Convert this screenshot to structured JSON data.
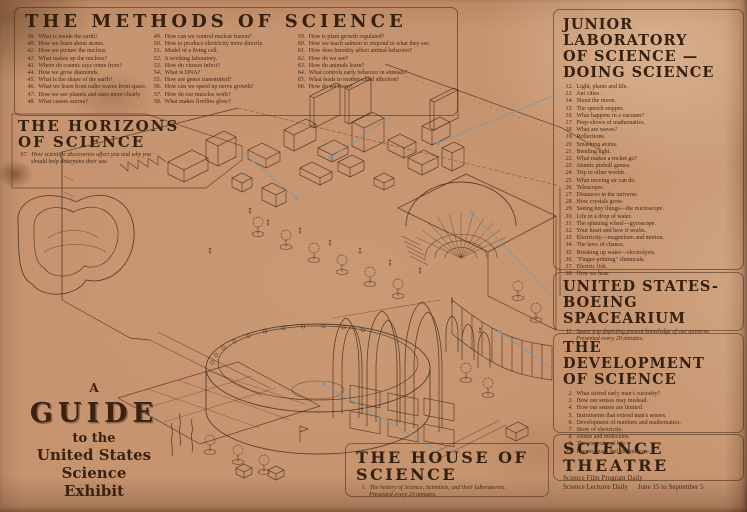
{
  "colors": {
    "paper": "#c6946f",
    "ink": "#4a3322",
    "leader": "#7b9aa4",
    "heading": "#33200f"
  },
  "guide_title": {
    "line1": "A",
    "line2": "GUIDE",
    "line3": "to the",
    "line4": "United States Science",
    "line5": "Exhibit"
  },
  "sections": {
    "methods": {
      "title": "THE METHODS OF SCIENCE",
      "columns": [
        [
          {
            "n": "39",
            "t": "What is inside the earth?"
          },
          {
            "n": "40",
            "t": "How we learn about atoms."
          },
          {
            "n": "41",
            "t": "How we picture the nucleus."
          },
          {
            "n": "42",
            "t": "What makes up the nucleus?"
          },
          {
            "n": "43",
            "t": "Where do cosmic rays come from?"
          },
          {
            "n": "44",
            "t": "How we grow diamonds."
          },
          {
            "n": "45",
            "t": "What is the shape of the earth?"
          },
          {
            "n": "46",
            "t": "What we learn from radio waves from space."
          },
          {
            "n": "47",
            "t": "How we see planets and stars more clearly"
          },
          {
            "n": "48",
            "t": "What causes aurora?"
          }
        ],
        [
          {
            "n": "49",
            "t": "How can we control nuclear fusion?"
          },
          {
            "n": "50",
            "t": "How to produce electricity more directly."
          },
          {
            "n": "51",
            "t": "Model of a living cell."
          },
          {
            "n": "52",
            "t": "A working laboratory."
          },
          {
            "n": "53",
            "t": "How do viruses infect?"
          },
          {
            "n": "54",
            "t": "What is DNA?"
          },
          {
            "n": "55",
            "t": "How are genes transmitted?"
          },
          {
            "n": "56",
            "t": "How can we speed up nerve growth?"
          },
          {
            "n": "57",
            "t": "How do our muscles work?"
          },
          {
            "n": "58",
            "t": "What makes fireflies glow?"
          }
        ],
        [
          {
            "n": "59",
            "t": "How is plant growth regulated?"
          },
          {
            "n": "60",
            "t": "How we teach salmon to respond to what they see."
          },
          {
            "n": "61",
            "t": "How does heredity affect animal behavior?"
          },
          {
            "n": "62",
            "t": "How do we see?"
          },
          {
            "n": "63",
            "t": "How do animals learn?"
          },
          {
            "n": "64",
            "t": "What controls early behavior in animals?"
          },
          {
            "n": "65",
            "t": "What leads to mother-child affection?"
          },
          {
            "n": "66",
            "t": "How do we learn?"
          }
        ]
      ]
    },
    "horizons": {
      "title_lines": [
        "THE HORIZONS",
        "OF SCIENCE"
      ],
      "items": [
        {
          "n": "67",
          "t": "How scientific discoveries affect you and why you should help determine their use."
        }
      ]
    },
    "junior": {
      "title_lines": [
        "JUNIOR LABORATORY",
        "OF SCIENCE —",
        "DOING SCIENCE"
      ],
      "items": [
        {
          "n": "12",
          "t": "Light, plants and life."
        },
        {
          "n": "13",
          "t": "Ant cities."
        },
        {
          "n": "14",
          "t": "Shoot the moon."
        },
        {
          "n": "15",
          "t": "The speech stopper."
        },
        {
          "n": "16",
          "t": "What happens in a vacuum?"
        },
        {
          "n": "17",
          "t": "Peep-shows of mathematics."
        },
        {
          "n": "18",
          "t": "What are waves?"
        },
        {
          "n": "19",
          "t": "Reflections."
        },
        {
          "n": "20",
          "t": "Smashing atoms."
        },
        {
          "n": "21",
          "t": "Bending light."
        },
        {
          "n": "22",
          "t": "What makes a rocket go?"
        },
        {
          "n": "23",
          "t": "Atomic pinball games."
        },
        {
          "n": "24",
          "t": "Trip to other worlds."
        },
        {
          "n": "25",
          "t": "What moving air can do."
        },
        {
          "n": "26",
          "t": "Telescopes."
        },
        {
          "n": "27",
          "t": "Distances in the universe."
        },
        {
          "n": "28",
          "t": "How crystals grow."
        },
        {
          "n": "29",
          "t": "Seeing tiny things—the microscope."
        },
        {
          "n": "30",
          "t": "Life in a drop of water."
        },
        {
          "n": "31",
          "t": "The spinning wheel—gyroscope."
        },
        {
          "n": "32",
          "t": "Your heart and how it works."
        },
        {
          "n": "33",
          "t": "Electricity—magnetism and motion."
        },
        {
          "n": "34",
          "t": "The laws of chance."
        },
        {
          "n": "35",
          "t": "Breaking up water—electrolysis."
        },
        {
          "n": "36",
          "t": "\"Finger-printing\" chemicals."
        },
        {
          "n": "37",
          "t": "Electric fish."
        },
        {
          "n": "38",
          "t": "How we hear."
        }
      ]
    },
    "spacearium": {
      "title_lines": [
        "UNITED STATES-",
        "BOEING SPACEARIUM"
      ],
      "items": [
        {
          "n": "11",
          "t": "Space trip depicting present knowledge of our universe. Presented every 20 minutes."
        }
      ]
    },
    "development": {
      "title_lines": [
        "THE DEVELOPMENT",
        "OF SCIENCE"
      ],
      "items": [
        {
          "n": "2",
          "t": "What stirred early man's curiosity?"
        },
        {
          "n": "3",
          "t": "How our senses may mislead."
        },
        {
          "n": "4",
          "t": "How our senses are limited."
        },
        {
          "n": "5",
          "t": "Instruments that extend man's senses."
        },
        {
          "n": "6",
          "t": "Development of numbers and mathematics."
        },
        {
          "n": "7",
          "t": "Story of electricity."
        },
        {
          "n": "8",
          "t": "Atoms and molecules."
        },
        {
          "n": "9",
          "t": "The on-going of life."
        },
        {
          "n": "10",
          "t": "Planets, stars and the universe."
        }
      ]
    },
    "theatre": {
      "title": "SCIENCE THEATRE",
      "film_line": "Science Film Program Daily",
      "lectures_line": "Science Lectures Daily",
      "dates": "June 15 to September 5"
    },
    "house": {
      "title": "THE HOUSE OF SCIENCE",
      "items": [
        {
          "n": "1",
          "t": "The history of Science, Scientists, and their laboratories. Presented every 20 minutes."
        }
      ]
    }
  }
}
